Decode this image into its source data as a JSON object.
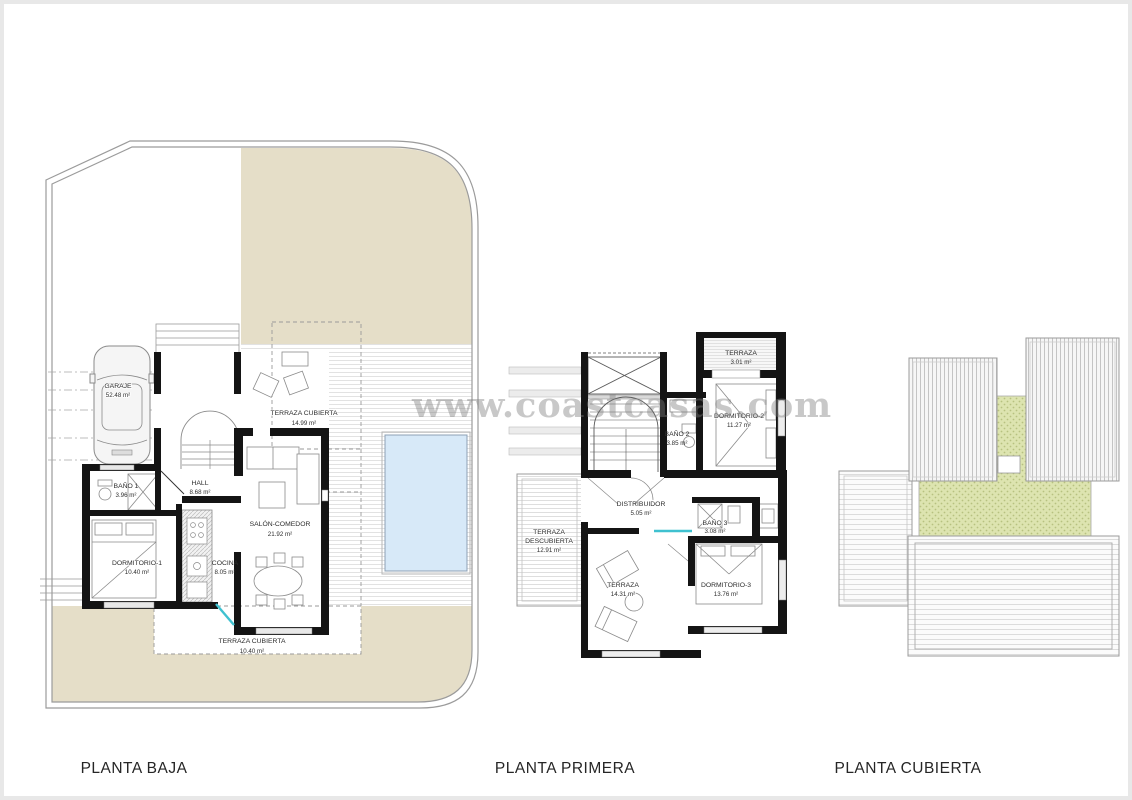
{
  "sheet": {
    "watermark": "www.coastcasas.com"
  },
  "plans": {
    "baja": {
      "title": "PLANTA BAJA",
      "rooms": {
        "garaje": {
          "name": "GARAJE",
          "area": "52.48 m²"
        },
        "bano1": {
          "name": "BAÑO 1",
          "area": "3.96 m²"
        },
        "hall": {
          "name": "HALL",
          "area": "8.68 m²"
        },
        "dormitorio1": {
          "name": "DORMITORIO-1",
          "area": "10.40 m²"
        },
        "cocina": {
          "name": "COCINA",
          "area": "8.05 m²"
        },
        "salon": {
          "name": "SALÓN-COMEDOR",
          "area": "21.92 m²"
        },
        "terrazaCubiertaAlta": {
          "name": "TERRAZA CUBIERTA",
          "area": "14.99 m²"
        },
        "terrazaCubiertaBaja": {
          "name": "TERRAZA CUBIERTA",
          "area": "10.40 m²"
        }
      }
    },
    "primera": {
      "title": "PLANTA PRIMERA",
      "rooms": {
        "terrazaAlta": {
          "name": "TERRAZA",
          "area": "3.01 m²"
        },
        "dormitorio2": {
          "name": "DORMITORIO-2",
          "area": "11.27 m²"
        },
        "bano2": {
          "name": "BAÑO 2",
          "area": "3.85 m²"
        },
        "distribuidor": {
          "name": "DISTRIBUIDOR",
          "area": "5.05 m²"
        },
        "bano3": {
          "name": "BAÑO 3",
          "area": "3.08 m²"
        },
        "terrazaDescubierta": {
          "line1": "TERRAZA",
          "line2": "DESCUBIERTA",
          "area": "12.91 m²"
        },
        "terrazaBaja": {
          "name": "TERRAZA",
          "area": "14.31 m²"
        },
        "dormitorio3": {
          "name": "DORMITORIO-3",
          "area": "13.76 m²"
        }
      }
    },
    "cubierta": {
      "title": "PLANTA CUBIERTA"
    }
  },
  "colors": {
    "plot_fill": "#e5dec8",
    "pool_fill": "#d7e9f8",
    "roof_garden_fill": "#dde4b0",
    "wall": "#141414",
    "boundary_line": "#9b9b9b",
    "glass_door": "#3fc1d0"
  }
}
